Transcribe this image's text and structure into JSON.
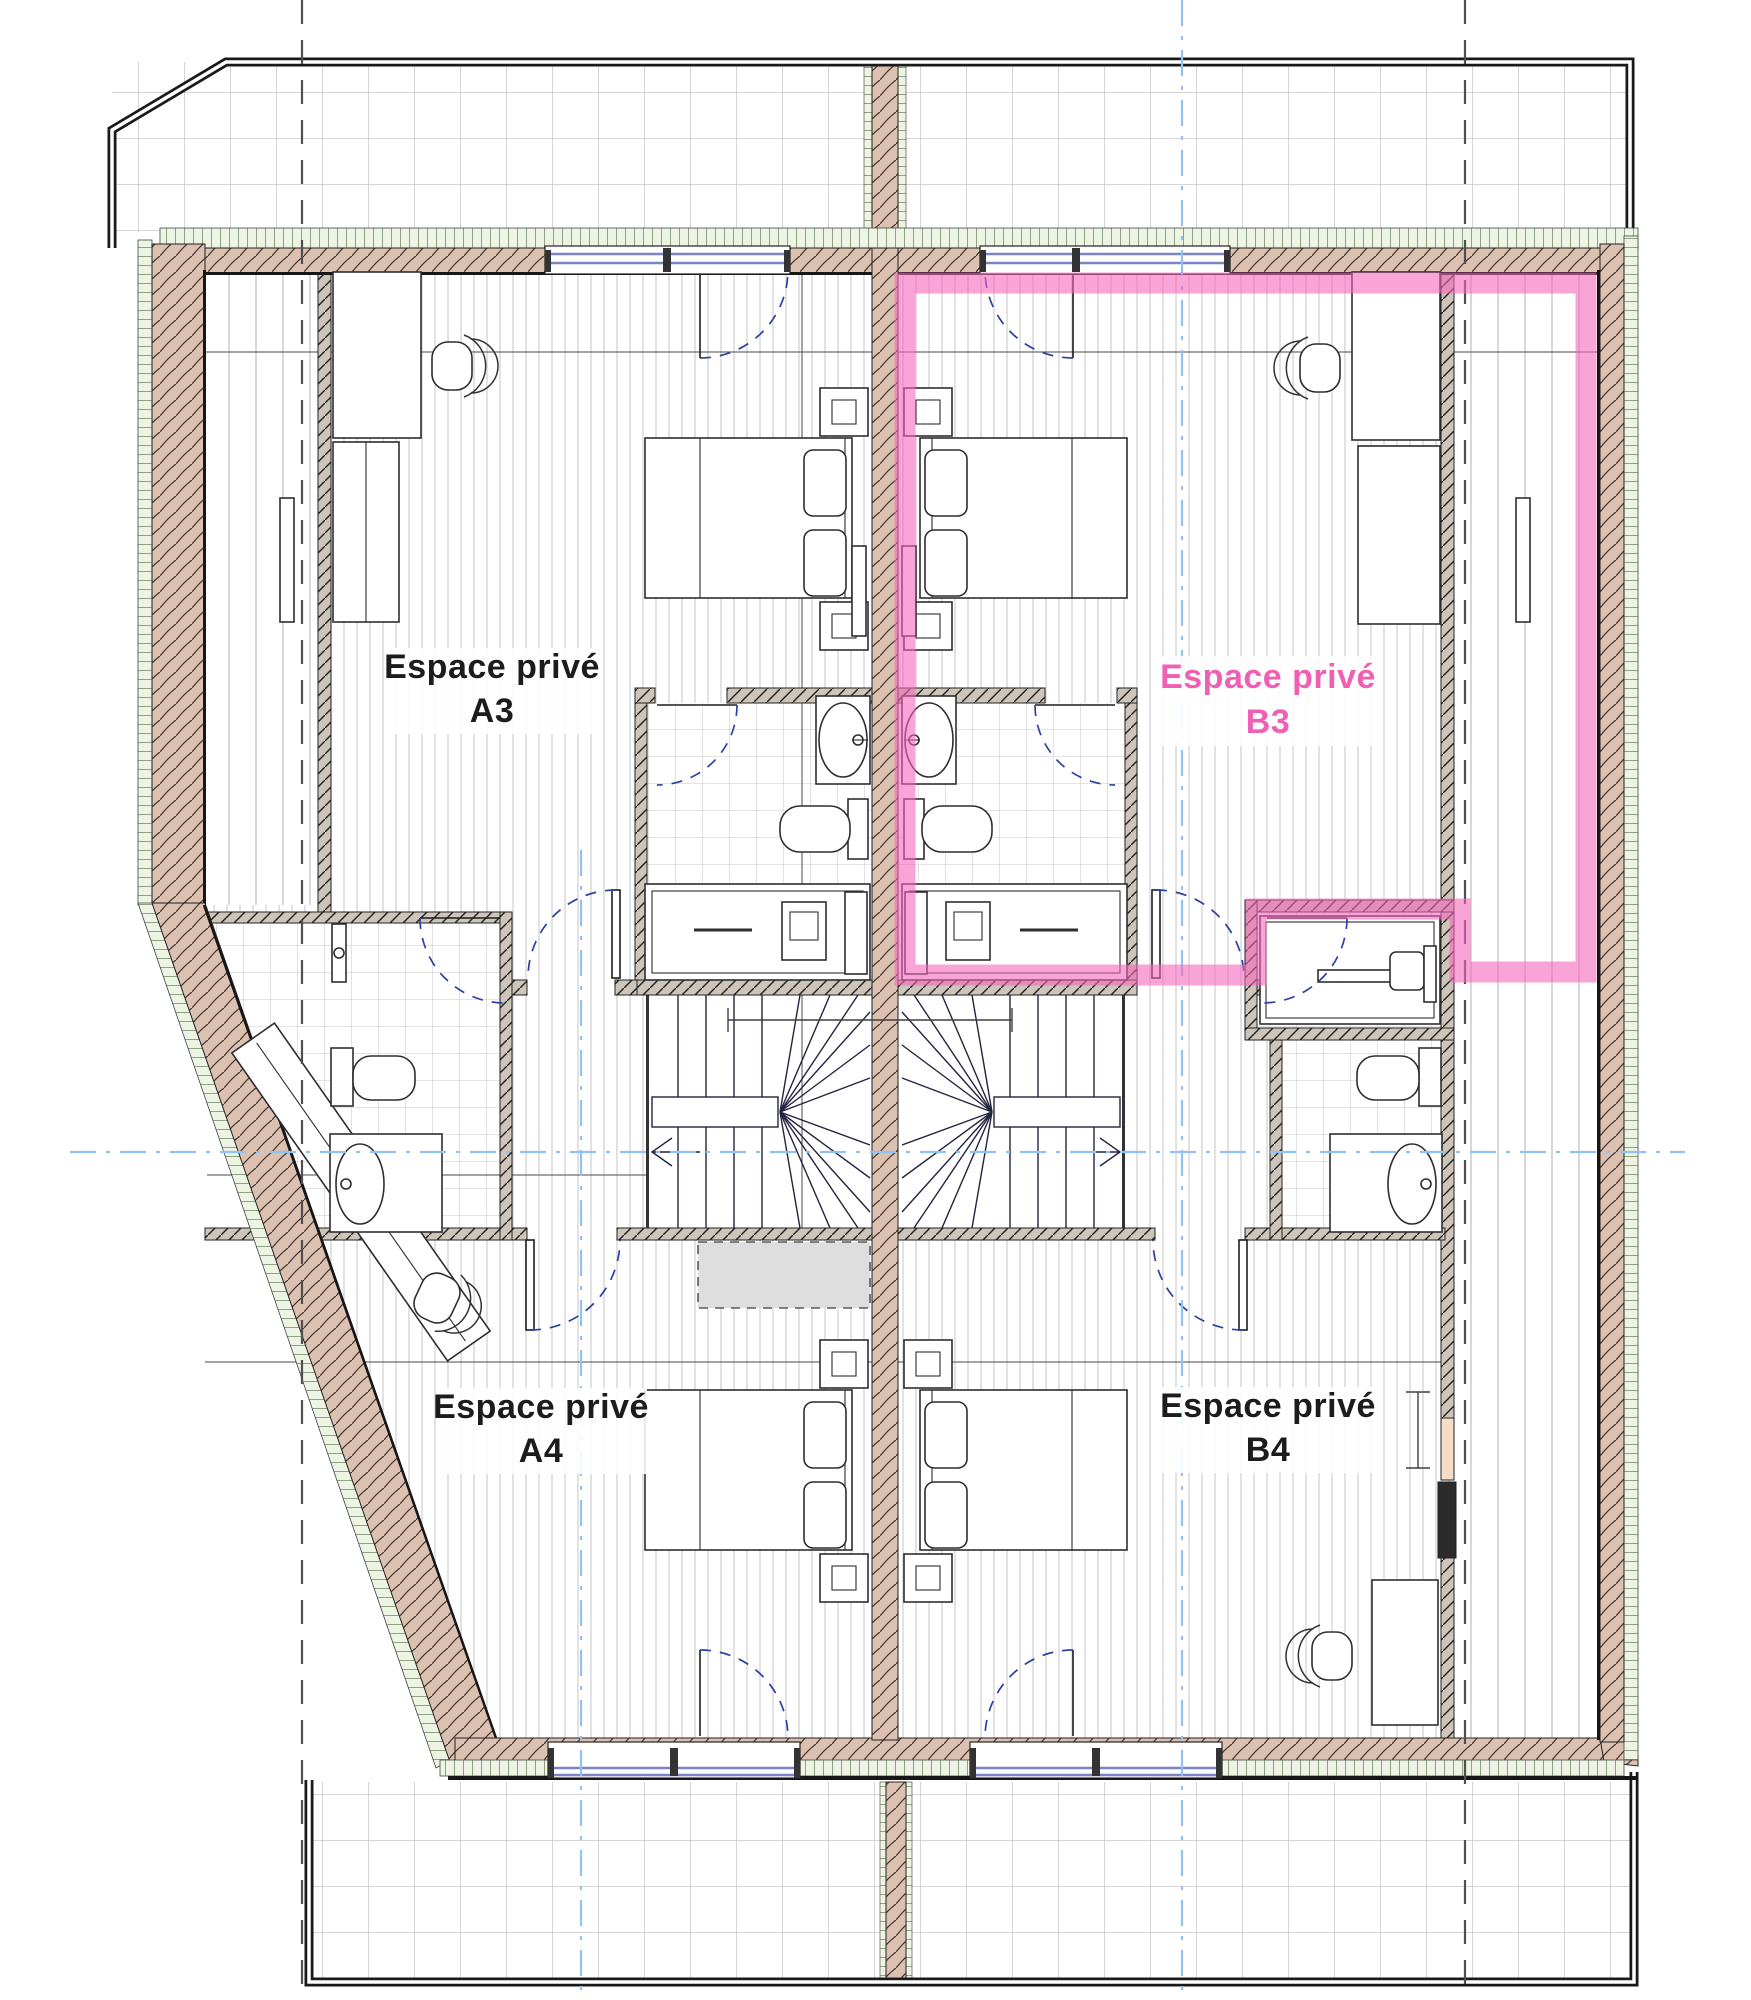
{
  "drawing": {
    "kind": "floor-plan",
    "background": "#ffffff"
  },
  "units": [
    {
      "code": "A3",
      "label_line1": "Espace privé",
      "label_line2": "A3",
      "text_color": "#1c1c1c",
      "highlighted": false
    },
    {
      "code": "B3",
      "label_line1": "Espace privé",
      "label_line2": "B3",
      "text_color": "#ef5fb4",
      "highlighted": true
    },
    {
      "code": "A4",
      "label_line1": "Espace privé",
      "label_line2": "A4",
      "text_color": "#1c1c1c",
      "highlighted": false
    },
    {
      "code": "B4",
      "label_line1": "Espace privé",
      "label_line2": "B4",
      "text_color": "#1c1c1c",
      "highlighted": false
    }
  ],
  "highlight": {
    "unit_code": "B3",
    "color": "#f368bd",
    "opacity": "0.6"
  },
  "colors": {
    "wall_wood": "#dcc0b0",
    "wall_partition": "#cdc5b9",
    "insulation_green": "#edf4e3",
    "window_glass": "#7b84c6",
    "floor_stripe": "#d2d2d2",
    "tile_line": "#c9c9c9",
    "terrace_grid": "#bdbdbd",
    "door_arc": "#2e41a0",
    "stair_line": "#23233f",
    "axis_blue": "#8fc3f4",
    "axis_dark": "#4f4f4f",
    "void_fill": "#dedede"
  }
}
